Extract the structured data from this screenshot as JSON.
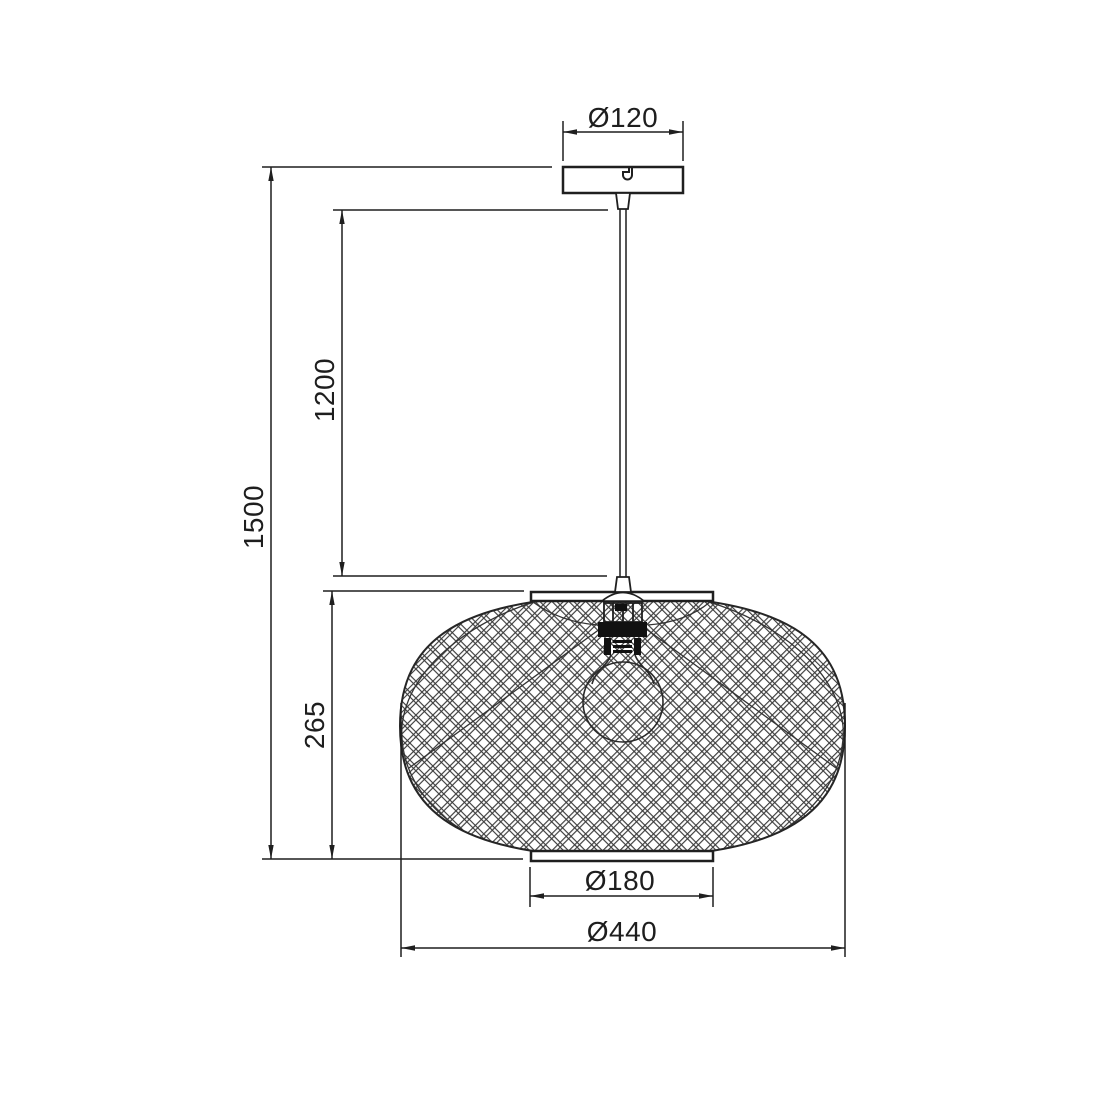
{
  "drawing": {
    "type": "technical-dimension-drawing",
    "subject": "pendant-lamp",
    "colors": {
      "background": "#ffffff",
      "line": "#1f1f1f",
      "mesh": "#3c3c3c",
      "text": "#1e1e1e"
    },
    "parts": {
      "canopy": "ceiling-canopy",
      "rod": "suspension-rod",
      "shade": "wire-mesh-shade",
      "bulb": "light-bulb",
      "top_plate": "shade-top-ring",
      "bottom_plate": "shade-bottom-ring"
    },
    "dimensions": {
      "canopy_diameter": {
        "label": "Ø120",
        "value": 120
      },
      "suspension_length": {
        "label": "1200",
        "value": 1200
      },
      "overall_height": {
        "label": "1500",
        "value": 1500
      },
      "shade_height": {
        "label": "265",
        "value": 265
      },
      "bottom_ring_diameter": {
        "label": "Ø180",
        "value": 180
      },
      "shade_diameter": {
        "label": "Ø440",
        "value": 440
      }
    }
  }
}
